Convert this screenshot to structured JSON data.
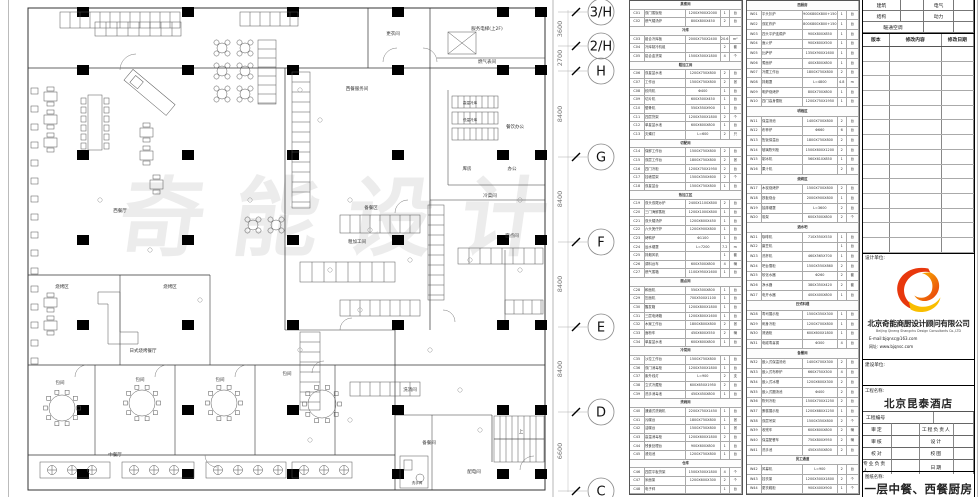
{
  "plan": {
    "watermark": "奇能设计",
    "rooms": [
      {
        "t": "更衣间",
        "x": 393,
        "y": 35
      },
      {
        "t": "服务电梯(上2F)",
        "x": 487,
        "y": 30
      },
      {
        "t": "燃气表间",
        "x": 487,
        "y": 63
      },
      {
        "t": "西餐服务间",
        "x": 357,
        "y": 90
      },
      {
        "t": "高温冷库",
        "x": 470,
        "y": 104,
        "f": 3.6
      },
      {
        "t": "低温冷库",
        "x": 470,
        "y": 121,
        "f": 3.6
      },
      {
        "t": "餐饮办公",
        "x": 515,
        "y": 128
      },
      {
        "t": "库房",
        "x": 467,
        "y": 170
      },
      {
        "t": "办公",
        "x": 512,
        "y": 170
      },
      {
        "t": "冷菜间",
        "x": 490,
        "y": 197
      },
      {
        "t": "备餐区",
        "x": 371,
        "y": 209
      },
      {
        "t": "西餐厅",
        "x": 120,
        "y": 212
      },
      {
        "t": "粗加工间",
        "x": 357,
        "y": 243
      },
      {
        "t": "面点间",
        "x": 512,
        "y": 237
      },
      {
        "t": "烧烤区",
        "x": 62,
        "y": 288
      },
      {
        "t": "烧烤区",
        "x": 170,
        "y": 288
      },
      {
        "t": "日式烧烤餐厅",
        "x": 143,
        "y": 352
      },
      {
        "t": "包间",
        "x": 60,
        "y": 384
      },
      {
        "t": "包间",
        "x": 140,
        "y": 381
      },
      {
        "t": "包间",
        "x": 220,
        "y": 381
      },
      {
        "t": "包间",
        "x": 287,
        "y": 375
      },
      {
        "t": "洗消间",
        "x": 410,
        "y": 391
      },
      {
        "t": "上",
        "x": 521,
        "y": 433
      },
      {
        "t": "备餐间",
        "x": 429,
        "y": 444
      },
      {
        "t": "中餐厅",
        "x": 115,
        "y": 456
      },
      {
        "t": "配电间",
        "x": 474,
        "y": 473
      },
      {
        "t": "洗手间",
        "x": 417,
        "y": 484,
        "f": 3.6
      }
    ],
    "grid": {
      "bubbles": [
        {
          "l": "3/H",
          "y": 12
        },
        {
          "l": "2/H",
          "y": 46
        },
        {
          "l": "H",
          "y": 71
        },
        {
          "l": "G",
          "y": 157
        },
        {
          "l": "F",
          "y": 242
        },
        {
          "l": "E",
          "y": 327
        },
        {
          "l": "D",
          "y": 412
        },
        {
          "l": "C",
          "y": 491
        }
      ],
      "dims": [
        {
          "v": "3600",
          "y": 29
        },
        {
          "v": "2700",
          "y": 58
        },
        {
          "v": "8400",
          "y": 114
        },
        {
          "v": "8400",
          "y": 199
        },
        {
          "v": "8400",
          "y": 284
        },
        {
          "v": "8400",
          "y": 369
        },
        {
          "v": "6600",
          "y": 451
        }
      ]
    }
  },
  "schedules": {
    "left_rows": [
      {
        "s": "蒸煮间"
      },
      {
        "c": "C01",
        "n": "双门蒸饭柜",
        "g": "1200X900X2000",
        "q": "1",
        "u": "台"
      },
      {
        "c": "C02",
        "n": "燃气矮汤炉",
        "g": "800X800X450",
        "q": "2",
        "u": "台"
      },
      {
        "s": "冷库"
      },
      {
        "c": "C03",
        "n": "组合冷库板",
        "g": "2000X750X2400",
        "q": "20.6",
        "u": "m²"
      },
      {
        "c": "C04",
        "n": "冷库制冷机组",
        "g": "",
        "q": "2",
        "u": "套"
      },
      {
        "c": "C05",
        "n": "铝合金货架",
        "g": "1500X500X1800",
        "q": "4",
        "u": "个"
      },
      {
        "s": "粗加工间"
      },
      {
        "c": "C06",
        "n": "双星盆水池",
        "g": "1200X750X800",
        "q": "2",
        "u": "台"
      },
      {
        "c": "C07",
        "n": "工作台",
        "g": "1500X750X800",
        "q": "2",
        "u": "张"
      },
      {
        "c": "C08",
        "n": "绞肉机",
        "g": "Φ400",
        "q": "1",
        "u": "台"
      },
      {
        "c": "C09",
        "n": "切片机",
        "g": "600X500X450",
        "q": "1",
        "u": "台"
      },
      {
        "c": "C10",
        "n": "锯骨机",
        "g": "550X550X900",
        "q": "1",
        "u": "台"
      },
      {
        "c": "C11",
        "n": "四层货架",
        "g": "1200X500X1800",
        "q": "2",
        "u": "个"
      },
      {
        "c": "C12",
        "n": "单星盆水池",
        "g": "600X600X800",
        "q": "1",
        "u": "台"
      },
      {
        "c": "C13",
        "n": "灭蝇灯",
        "g": "L=600",
        "q": "2",
        "u": "只"
      },
      {
        "s": "切配间"
      },
      {
        "c": "C14",
        "n": "保鲜工作台",
        "g": "1500X750X800",
        "q": "2",
        "u": "台"
      },
      {
        "c": "C15",
        "n": "双层工作台",
        "g": "1800X750X800",
        "q": "2",
        "u": "张"
      },
      {
        "c": "C16",
        "n": "四门冷柜",
        "g": "1200X750X1950",
        "q": "2",
        "u": "台"
      },
      {
        "c": "C17",
        "n": "挂墙层架",
        "g": "1500X350X600",
        "q": "2",
        "u": "个"
      },
      {
        "c": "C18",
        "n": "双星盆台",
        "g": "1500X750X800",
        "q": "1",
        "u": "台"
      },
      {
        "s": "热加工区"
      },
      {
        "c": "C19",
        "n": "双头双尾炒炉",
        "g": "2400X1100X800",
        "q": "2",
        "u": "台"
      },
      {
        "c": "C20",
        "n": "三门海鲜蒸柜",
        "g": "1200X1000X800",
        "q": "1",
        "u": "台"
      },
      {
        "c": "C21",
        "n": "双头矮汤炉",
        "g": "1200X600X450",
        "q": "1",
        "u": "台"
      },
      {
        "c": "C22",
        "n": "六头煲仔炉",
        "g": "1200X900X800",
        "q": "1",
        "u": "台"
      },
      {
        "c": "C23",
        "n": "烤鸭炉",
        "g": "Φ1100",
        "q": "1",
        "u": "台"
      },
      {
        "c": "C24",
        "n": "运水烟罩",
        "g": "L=7200",
        "q": "7.2",
        "u": "m"
      },
      {
        "c": "C25",
        "n": "排烟风机",
        "g": "",
        "q": "1",
        "u": "套"
      },
      {
        "c": "C26",
        "n": "调料台车",
        "g": "600X500X800",
        "q": "4",
        "u": "辆"
      },
      {
        "c": "C27",
        "n": "燃气蒸箱",
        "g": "1100X950X1600",
        "q": "1",
        "u": "台"
      },
      {
        "s": "面点间"
      },
      {
        "c": "C28",
        "n": "和面机",
        "g": "550X500X800",
        "q": "1",
        "u": "台"
      },
      {
        "c": "C29",
        "n": "压面机",
        "g": "700X500X1100",
        "q": "1",
        "u": "台"
      },
      {
        "c": "C30",
        "n": "醒发箱",
        "g": "1200X800X1800",
        "q": "1",
        "u": "台"
      },
      {
        "c": "C31",
        "n": "三层电烤箱",
        "g": "1200X800X1600",
        "q": "1",
        "u": "台"
      },
      {
        "c": "C32",
        "n": "木案工作台",
        "g": "1800X800X800",
        "q": "2",
        "u": "张"
      },
      {
        "c": "C33",
        "n": "面粉车",
        "g": "450X600X550",
        "q": "2",
        "u": "辆"
      },
      {
        "c": "C34",
        "n": "单星盆水池",
        "g": "600X600X800",
        "q": "1",
        "u": "台"
      },
      {
        "s": "冷菜间"
      },
      {
        "c": "C35",
        "n": "沙拉工作台",
        "g": "1500X750X800",
        "q": "1",
        "u": "台"
      },
      {
        "c": "C36",
        "n": "双门消毒柜",
        "g": "1200X500X1800",
        "q": "1",
        "u": "台"
      },
      {
        "c": "C37",
        "n": "紫外线灯",
        "g": "L=900",
        "q": "2",
        "u": "支"
      },
      {
        "c": "C38",
        "n": "立式冷藏柜",
        "g": "600X650X1950",
        "q": "2",
        "u": "台"
      },
      {
        "c": "C39",
        "n": "洗手消毒池",
        "g": "450X450X800",
        "q": "1",
        "u": "台"
      },
      {
        "s": "洗碗间"
      },
      {
        "c": "C40",
        "n": "通道式洗碗机",
        "g": "2200X750X1450",
        "q": "1",
        "u": "台"
      },
      {
        "c": "C41",
        "n": "污碟台",
        "g": "1800X750X800",
        "q": "1",
        "u": "张"
      },
      {
        "c": "C42",
        "n": "洁碟台",
        "g": "1500X750X800",
        "q": "1",
        "u": "张"
      },
      {
        "c": "C43",
        "n": "高温消毒柜",
        "g": "1200X600X1800",
        "q": "2",
        "u": "台"
      },
      {
        "c": "C44",
        "n": "残食处理台",
        "g": "900X600X800",
        "q": "1",
        "u": "台"
      },
      {
        "c": "C45",
        "n": "浸泡池",
        "g": "1200X750X800",
        "q": "1",
        "u": "台"
      },
      {
        "s": "仓库"
      },
      {
        "c": "C46",
        "n": "四层平板货架",
        "g": "1500X500X1800",
        "q": "4",
        "u": "个"
      },
      {
        "c": "C47",
        "n": "米面架",
        "g": "1200X600X300",
        "q": "2",
        "u": "个"
      },
      {
        "c": "C48",
        "n": "电子秤",
        "g": "",
        "q": "1",
        "u": "台"
      }
    ],
    "right_rows": [
      {
        "s": "西厨房"
      },
      {
        "c": "W01",
        "n": "平头扒炉",
        "g": "900X800X800+150",
        "q": "1",
        "u": "台"
      },
      {
        "c": "W02",
        "n": "双缸炸炉",
        "g": "800X800X800+150",
        "q": "1",
        "u": "台"
      },
      {
        "c": "W03",
        "n": "四头平炉连焗炉",
        "g": "900X800X850",
        "q": "1",
        "u": "台"
      },
      {
        "c": "W04",
        "n": "面火炉",
        "g": "900X600X500",
        "q": "1",
        "u": "台"
      },
      {
        "c": "W05",
        "n": "比萨炉",
        "g": "1350X900X1600",
        "q": "1",
        "u": "台"
      },
      {
        "c": "W06",
        "n": "煮面炉",
        "g": "400X800X800",
        "q": "1",
        "u": "台"
      },
      {
        "c": "W07",
        "n": "冷藏工作台",
        "g": "1800X750X800",
        "q": "2",
        "u": "台"
      },
      {
        "c": "W08",
        "n": "排烟罩",
        "g": "L=4800",
        "q": "4.8",
        "u": "m"
      },
      {
        "c": "W09",
        "n": "明炉烧烤炉",
        "g": "800X700X800",
        "q": "1",
        "u": "台"
      },
      {
        "c": "W10",
        "n": "四门高身雪柜",
        "g": "1200X750X1950",
        "q": "1",
        "u": "台"
      },
      {
        "s": "明档区"
      },
      {
        "c": "W11",
        "n": "保温汤池",
        "g": "1400X700X800",
        "q": "2",
        "u": "台"
      },
      {
        "c": "W12",
        "n": "布菲炉",
        "g": "Φ660",
        "q": "6",
        "u": "台"
      },
      {
        "c": "W13",
        "n": "售饭保温台",
        "g": "1800X750X800",
        "q": "2",
        "u": "台"
      },
      {
        "c": "W14",
        "n": "玻璃陈列柜",
        "g": "1500X600X1200",
        "q": "2",
        "u": "台"
      },
      {
        "c": "W15",
        "n": "制冰机",
        "g": "560X610X850",
        "q": "1",
        "u": "台"
      },
      {
        "c": "W16",
        "n": "果汁机",
        "g": "",
        "q": "2",
        "u": "台"
      },
      {
        "s": "烧烤区"
      },
      {
        "c": "W17",
        "n": "木炭烧烤炉",
        "g": "1500X700X800",
        "q": "2",
        "u": "台"
      },
      {
        "c": "W18",
        "n": "铁板烧台",
        "g": "2000X900X800",
        "q": "1",
        "u": "台"
      },
      {
        "c": "W19",
        "n": "抽排烟罩",
        "g": "L=3600",
        "q": "2",
        "u": "台"
      },
      {
        "c": "W20",
        "n": "炭架",
        "g": "600X500X800",
        "q": "2",
        "u": "个"
      },
      {
        "s": "酒水吧"
      },
      {
        "c": "W21",
        "n": "咖啡机",
        "g": "710X550X530",
        "q": "1",
        "u": "台"
      },
      {
        "c": "W22",
        "n": "磨豆机",
        "g": "",
        "q": "1",
        "u": "台"
      },
      {
        "c": "W23",
        "n": "洗杯机",
        "g": "460X565X700",
        "q": "1",
        "u": "台"
      },
      {
        "c": "W24",
        "n": "吧台雪柜",
        "g": "1500X550X860",
        "q": "2",
        "u": "台"
      },
      {
        "c": "W25",
        "n": "软化水器",
        "g": "Φ260",
        "q": "2",
        "u": "套"
      },
      {
        "c": "W26",
        "n": "净水器",
        "g": "380X350X420",
        "q": "2",
        "u": "套"
      },
      {
        "c": "W27",
        "n": "电开水器",
        "g": "400X400X800",
        "q": "1",
        "u": "台"
      },
      {
        "s": "日式料理"
      },
      {
        "c": "W28",
        "n": "寿司展示柜",
        "g": "1500X350X300",
        "q": "1",
        "u": "台"
      },
      {
        "c": "W29",
        "n": "刺身冷柜",
        "g": "1200X700X800",
        "q": "1",
        "u": "台"
      },
      {
        "c": "W30",
        "n": "清酒柜",
        "g": "600X600X1800",
        "q": "1",
        "u": "台"
      },
      {
        "c": "W31",
        "n": "电磁寿喜锅",
        "g": "Φ300",
        "q": "4",
        "u": "台"
      },
      {
        "s": "备餐间"
      },
      {
        "c": "W32",
        "n": "嵌入式保温汤池",
        "g": "1400X700X300",
        "q": "2",
        "u": "台"
      },
      {
        "c": "W33",
        "n": "嵌入式布菲炉",
        "g": "660X750X300",
        "q": "4",
        "u": "台"
      },
      {
        "c": "W34",
        "n": "嵌入式冰槽",
        "g": "1200X600X300",
        "q": "2",
        "u": "台"
      },
      {
        "c": "W35",
        "n": "嵌入式圆汤池",
        "g": "Φ400",
        "q": "2",
        "u": "台"
      },
      {
        "c": "W36",
        "n": "陈列冷柜",
        "g": "1500X700X1250",
        "q": "2",
        "u": "台"
      },
      {
        "c": "W37",
        "n": "蛋糕展示柜",
        "g": "1200X680X1250",
        "q": "1",
        "u": "台"
      },
      {
        "c": "W38",
        "n": "双层吊架",
        "g": "1500X350X800",
        "q": "2",
        "u": "个"
      },
      {
        "c": "W39",
        "n": "收残车",
        "g": "600X600X800",
        "q": "2",
        "u": "辆"
      },
      {
        "c": "W40",
        "n": "保温配餐车",
        "g": "750X800X950",
        "q": "2",
        "u": "辆"
      },
      {
        "c": "W41",
        "n": "洗手池",
        "g": "450X450X800",
        "q": "2",
        "u": "台"
      },
      {
        "s": "员工通道"
      },
      {
        "c": "W42",
        "n": "风幕机",
        "g": "L=900",
        "q": "2",
        "u": "台"
      },
      {
        "c": "W43",
        "n": "挂衣架",
        "g": "1200X500X1800",
        "q": "2",
        "u": "个"
      },
      {
        "c": "W44",
        "n": "更衣鞋柜",
        "g": "900X400X900",
        "q": "1",
        "u": "个"
      }
    ]
  },
  "titleblock": {
    "disciplines": [
      [
        "建筑",
        "电气"
      ],
      [
        "结构",
        "动力"
      ],
      [
        "暖通空调",
        ""
      ]
    ],
    "revision": {
      "headers": [
        "版本",
        "修改内容",
        "修改日期"
      ],
      "empty_rows": 14
    },
    "design_unit_label": "设计单位:",
    "company_cn": "北京奇能商厨设计顾问有限公司",
    "company_en": "Beijing Qineng Shangchu Design Consultants Co.,LTD",
    "email": "E-mail:bjqnsc@163.com",
    "website": "网址: www.bjqnsc.com",
    "client_label": "建设单位:",
    "project_label": "工程名称:",
    "project_name": "北京昆泰酒店",
    "project_no_label": "工程编号",
    "approvals": [
      [
        "审定",
        "工程负责人"
      ],
      [
        "审核",
        "设计"
      ],
      [
        "校对",
        "校图"
      ],
      [
        "专业负责人",
        "日期"
      ]
    ],
    "sheet_label": "图纸名称:",
    "sheet_name": "一层中餐、西餐厨房",
    "logo_colors": {
      "red": "#e8380d",
      "orange": "#f08300",
      "yellow": "#f9be00"
    }
  }
}
